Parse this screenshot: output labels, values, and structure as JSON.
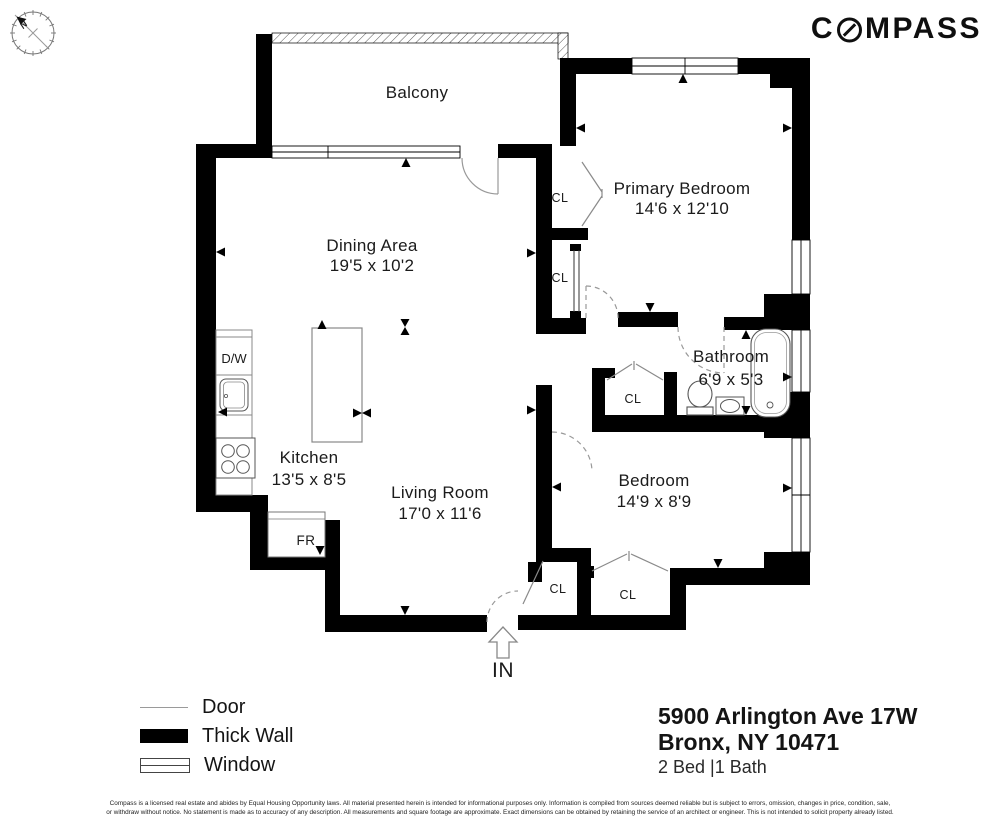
{
  "brand": {
    "logo_prefix": "C",
    "logo_suffix": "MPASS",
    "north_label": "N"
  },
  "floor_plan": {
    "rooms": {
      "balcony": {
        "name": "Balcony",
        "dims": ""
      },
      "dining": {
        "name": "Dining Area",
        "dims": "19'5 x 10'2"
      },
      "primary_bedroom": {
        "name": "Primary Bedroom",
        "dims": "14'6 x 12'10"
      },
      "kitchen": {
        "name": "Kitchen",
        "dims": "13'5 x 8'5"
      },
      "living_room": {
        "name": "Living Room",
        "dims": "17'0 x 11'6"
      },
      "bathroom": {
        "name": "Bathroom",
        "dims": "6'9 x 5'3"
      },
      "bedroom": {
        "name": "Bedroom",
        "dims": "14'9 x 8'9"
      }
    },
    "labels": {
      "closet": "CL",
      "dishwasher": "D/W",
      "fridge": "FR",
      "entry": "IN"
    }
  },
  "legend": {
    "items": [
      {
        "label": "Door"
      },
      {
        "label": "Thick Wall"
      },
      {
        "label": "Window"
      }
    ]
  },
  "listing": {
    "address_line1": "5900 Arlington Ave 17W",
    "address_line2": "Bronx, NY 10471",
    "beds_baths": "2 Bed |1 Bath"
  },
  "footer": {
    "line1": "Compass is a licensed real estate and abides by Equal Housing Opportunity laws. All material presented herein is intended for informational purposes only. Information is compiled from sources deemed reliable but is subject to errors, omission, changes in price, condition, sale,",
    "line2": "or withdraw without notice. No statement is made as to accuracy of any description. All measurements and square footage are approximate. Exact dimensions can be obtained by retaining the service of an architect or engineer. This is not intended to solicit property already listed."
  },
  "colors": {
    "wall": "#000000",
    "door_line": "#999999",
    "text": "#1b1b1b",
    "brand": "#0f0f0f"
  }
}
